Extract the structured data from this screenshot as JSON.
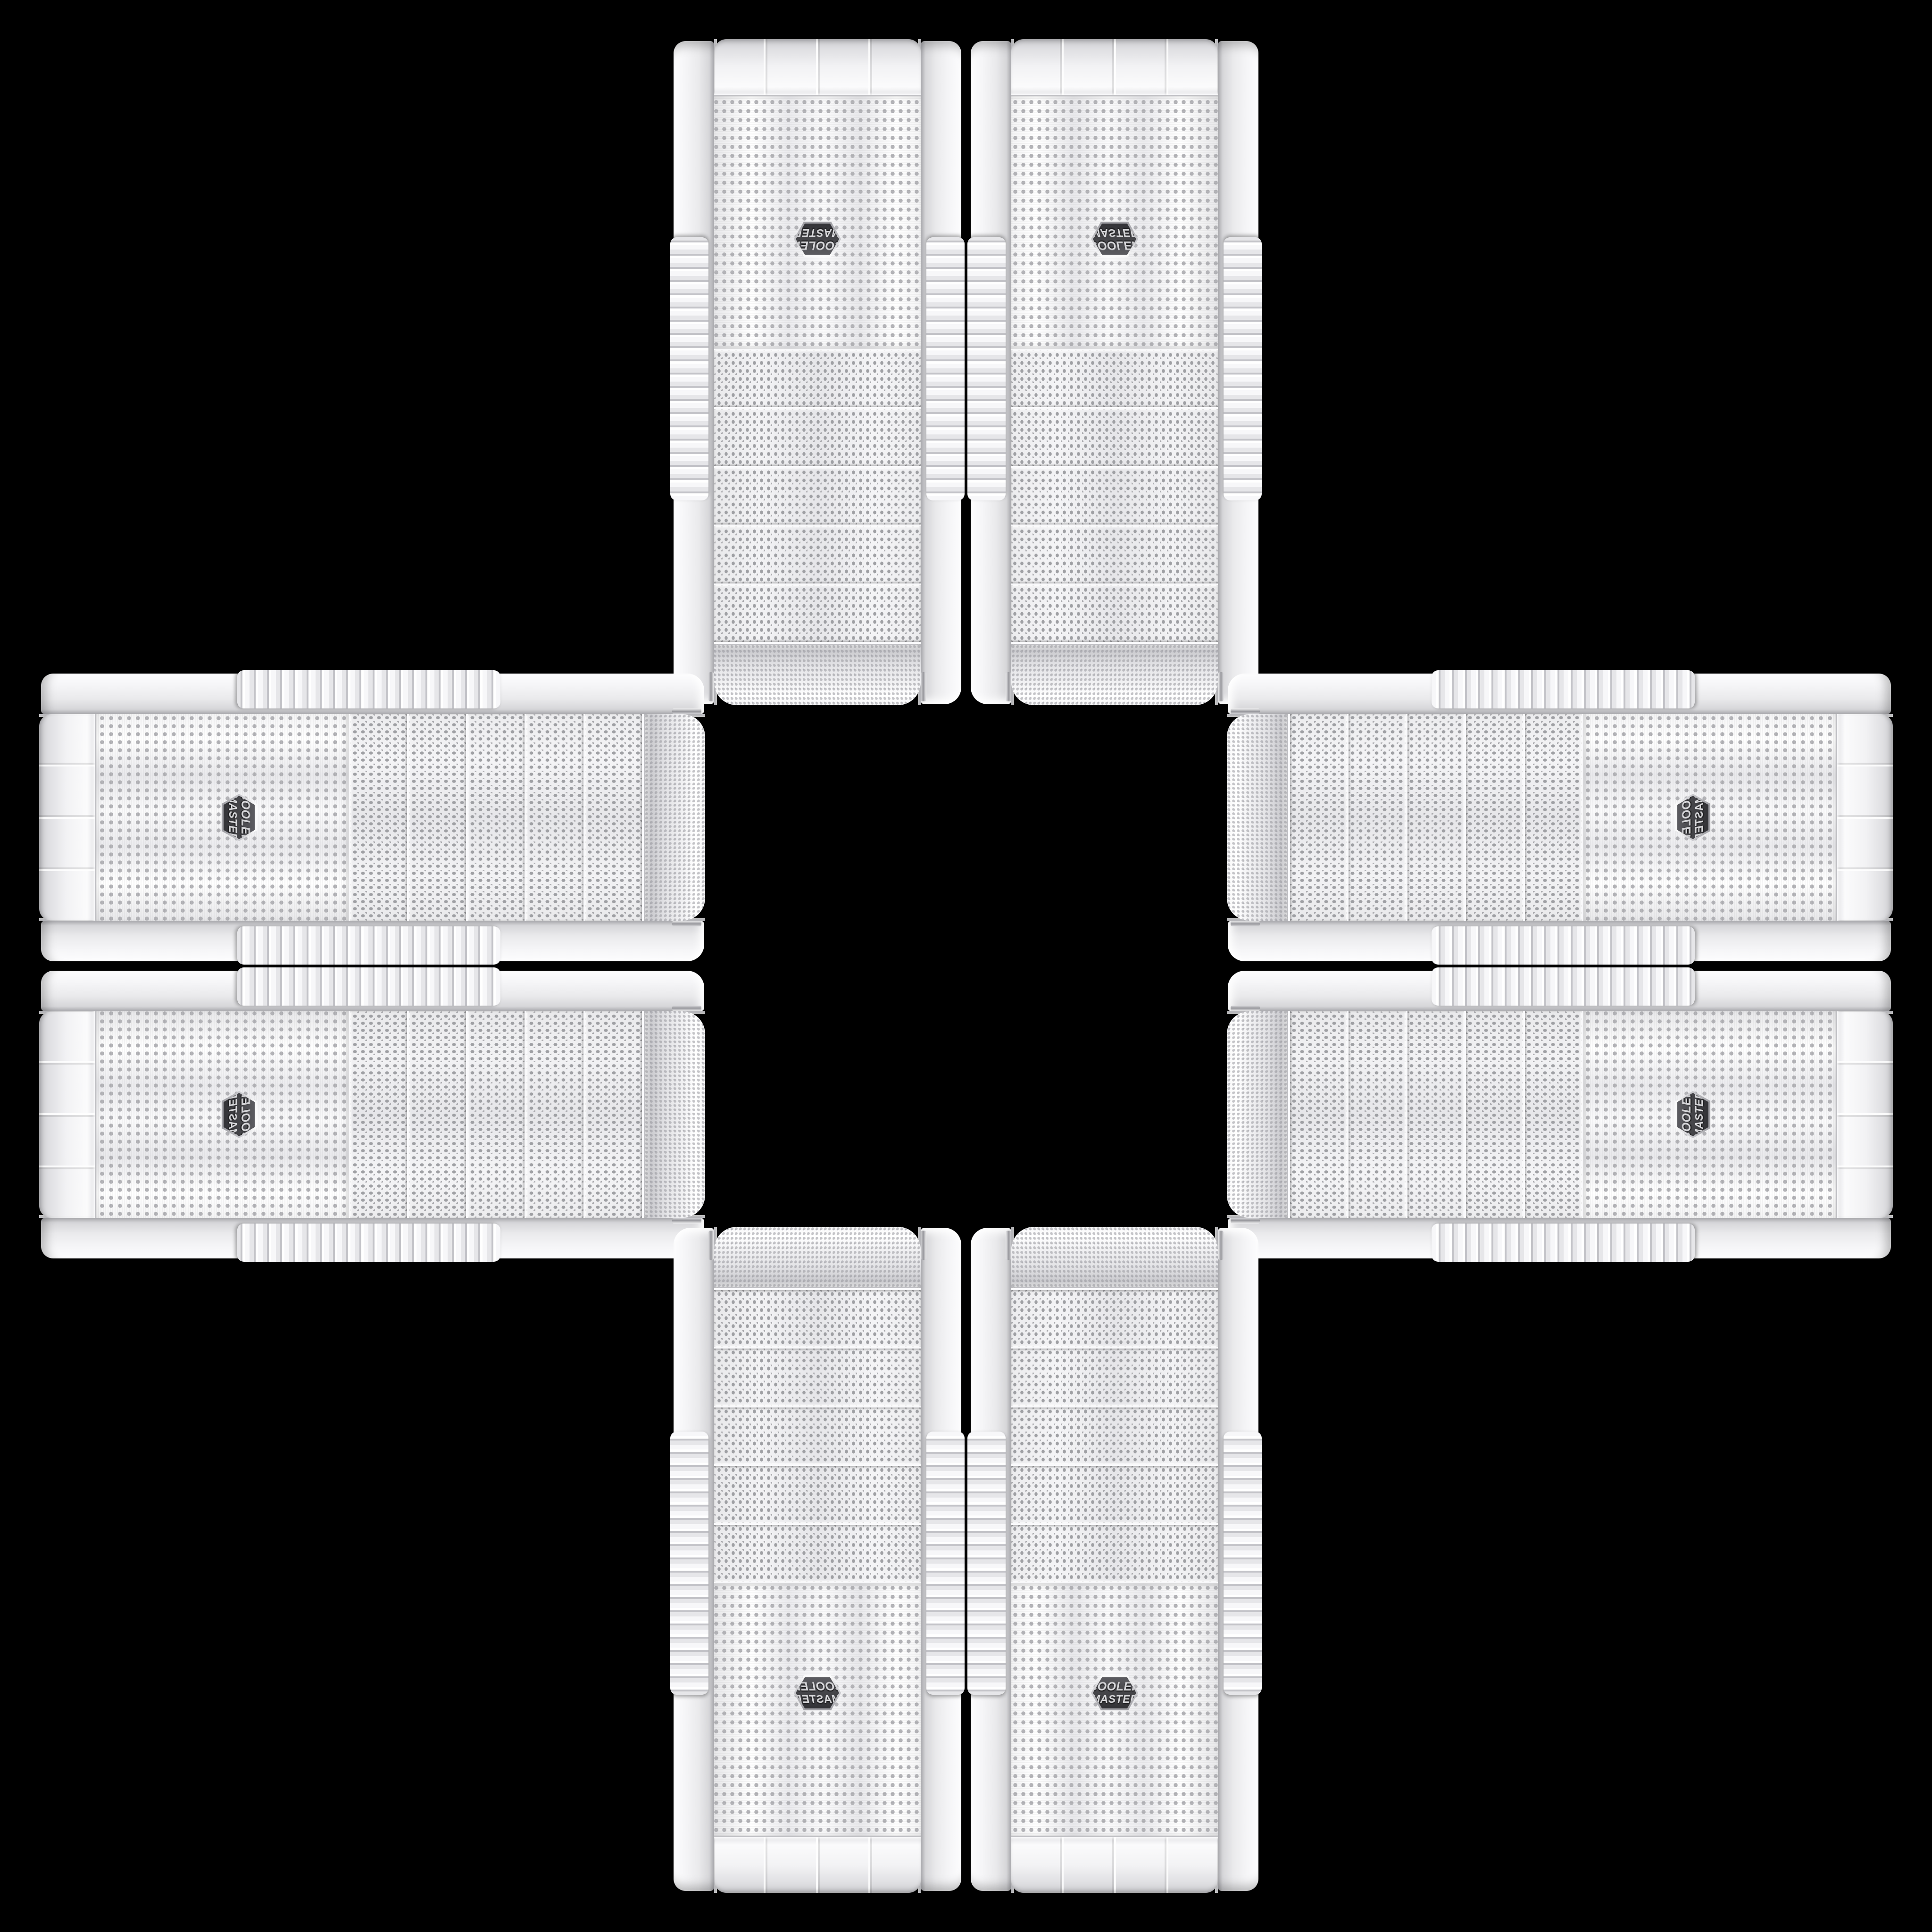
{
  "scene": {
    "background_color": "#000000",
    "units": [
      {
        "id": "tower-top-left",
        "axis": "vertical",
        "orientation": "rot180"
      },
      {
        "id": "tower-top-right",
        "axis": "vertical",
        "orientation": "flip-y"
      },
      {
        "id": "case-left-top",
        "axis": "horizontal",
        "orientation": "rot90"
      },
      {
        "id": "case-right-top",
        "axis": "horizontal",
        "orientation": "rot90-flip-x"
      },
      {
        "id": "case-left-bottom",
        "axis": "horizontal",
        "orientation": "rot90-flip-y"
      },
      {
        "id": "case-right-bottom",
        "axis": "horizontal",
        "orientation": "rot270"
      },
      {
        "id": "tower-bottom-left",
        "axis": "vertical",
        "orientation": "flip-x"
      },
      {
        "id": "tower-bottom-right",
        "axis": "vertical",
        "orientation": "normal"
      }
    ]
  },
  "badge": {
    "line1": "COOLER",
    "line2": "MASTER",
    "face_color": "#47474b",
    "text_color": "#d6d6d9",
    "rim_color": "#cfcfd3"
  },
  "palette": {
    "case_body": "#f0f0f2",
    "rail_shadow": "#aaaaae",
    "mesh_dot": "#a7a7ab",
    "chrome_trim": "#97979c",
    "background": "#000000"
  }
}
